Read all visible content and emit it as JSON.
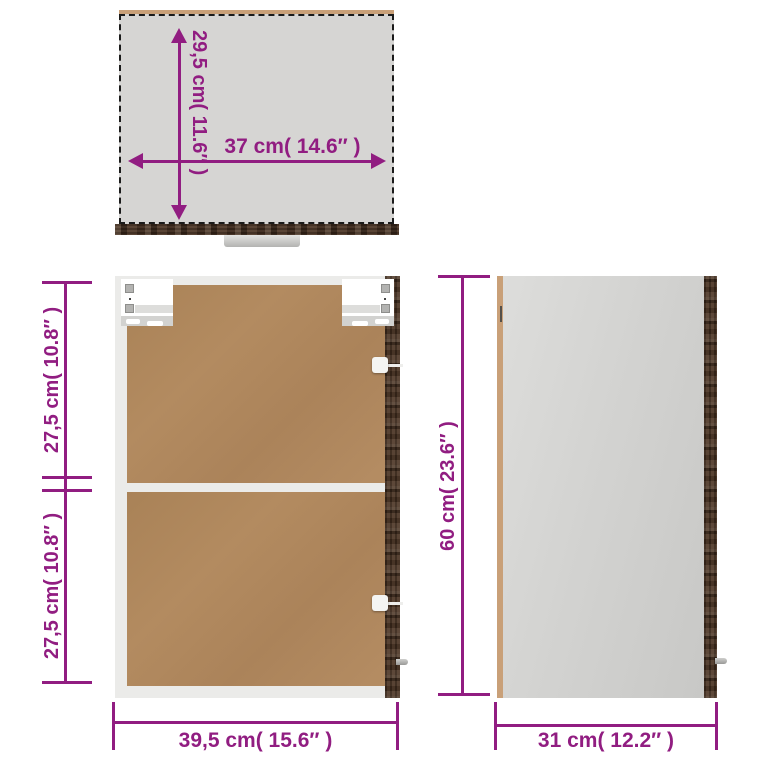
{
  "product": "wall-cabinet-dimension-diagram",
  "dimensions": {
    "top_view": {
      "depth": "29,5 cm( 11.6″ )",
      "width": "37 cm( 14.6″ )"
    },
    "front_view": {
      "upper_height": "27,5 cm( 10.8″ )",
      "lower_height": "27,5 cm( 10.8″ )",
      "width": "39,5 cm( 15.6″ )"
    },
    "side_view": {
      "height": "60 cm( 23.6″ )",
      "depth": "31 cm( 12.2″ )"
    }
  },
  "colors": {
    "dimension_purple": "#911d81",
    "panel_brown": "#b1895e",
    "wood_dark": "#4a3322",
    "top_view_gray": "#d6d5d3",
    "side_panel_gray": "#d2d2d0",
    "edge_tan": "#c9a078",
    "frame_white": "#ebebe9"
  }
}
